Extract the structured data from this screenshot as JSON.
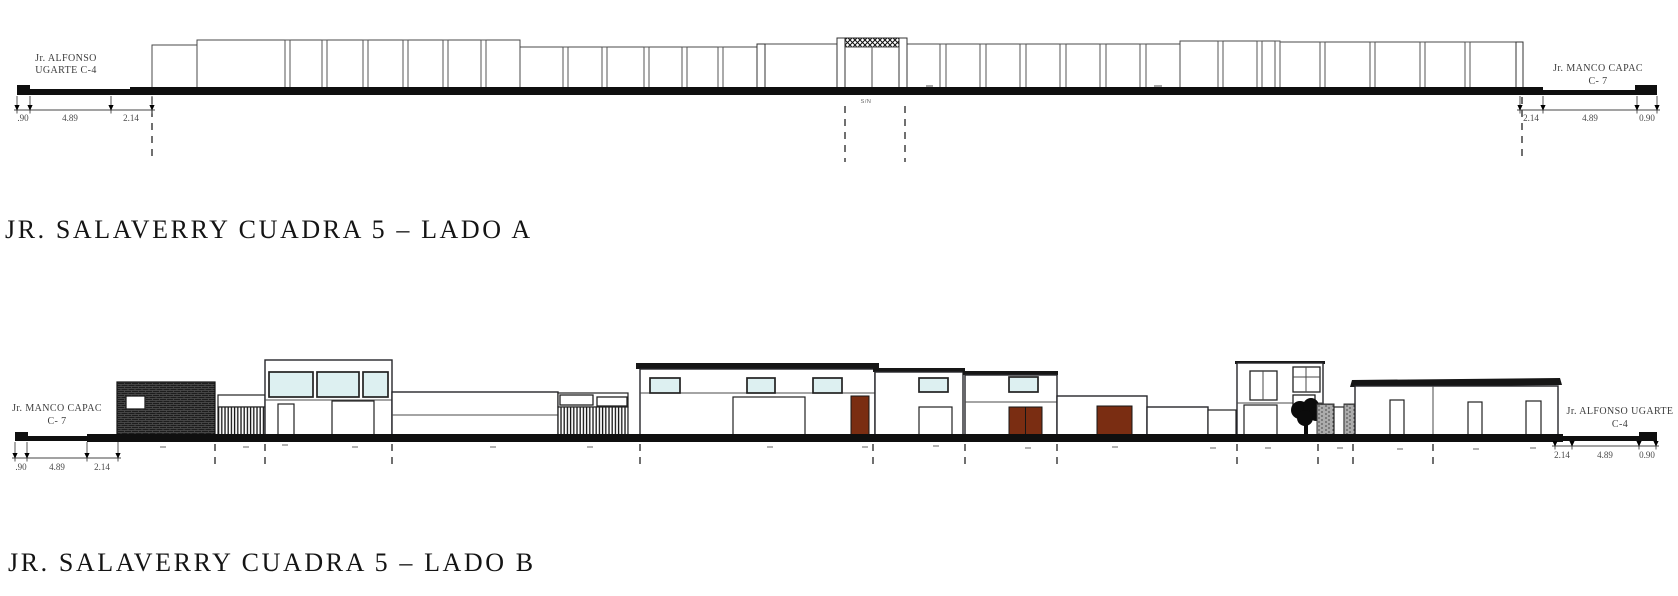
{
  "elevation_a": {
    "title": "JR. SALAVERRY CUADRA 5 – LADO A",
    "street_label_left": {
      "line1": "Jr. ALFONSO",
      "line2": "UGARTE C-4"
    },
    "street_label_right": {
      "line1": "Jr. MANCO CAPAC",
      "line2": "C- 7"
    },
    "dimensions_left": [
      ".90",
      "4.89",
      "2.14"
    ],
    "dimensions_right": [
      "2.14",
      "4.89",
      "0.90"
    ],
    "annotation_sn": "S/N"
  },
  "elevation_b": {
    "title": "JR. SALAVERRY CUADRA 5 – LADO B",
    "street_label_left": {
      "line1": "Jr. MANCO CAPAC",
      "line2": "C- 7"
    },
    "street_label_right": {
      "line1": "Jr. ALFONSO UGARTE",
      "line2": "C-4"
    },
    "dimensions_left": [
      ".90",
      "4.89",
      "2.14"
    ],
    "dimensions_right": [
      "2.14",
      "4.89",
      "0.90"
    ]
  },
  "colors": {
    "line": "#1a1a1a",
    "secondary_line": "#4a4a4a",
    "window_glass": "#ddf0f1",
    "door_wood": "#7a2d12",
    "dark_fill": "#161616",
    "dimension_text": "#4a4a4a"
  }
}
